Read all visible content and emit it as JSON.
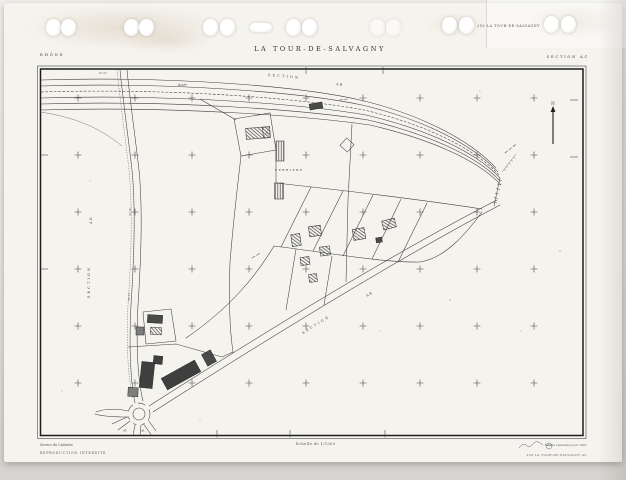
{
  "page": {
    "department": "RHÔNE",
    "title": "LA TOUR-DE-SALVAGNY",
    "section": "SECTION AC",
    "sheet_ref": "250 LA TOUR-DE-SALVAGNY"
  },
  "map": {
    "north": "N",
    "section_labels": {
      "top_word": "SECTION",
      "top_code": "AB",
      "west_word": "SECTION",
      "west_code": "AD",
      "south_word": "SECTION",
      "south_code": "AB"
    },
    "road_label": "Route",
    "lieu_dit": "FERRIERE",
    "adjacent_sheet_left": "AY",
    "adjacent_sheet_right": "AL"
  },
  "footer": {
    "issuer": "Service du Cadastre",
    "notice": "REPRODUCTION INTERDITE",
    "scale": "Echelle de 1/1000",
    "revision_note": "Feuille remaniée pour 1981",
    "sheet_id": "250 LA TOUR-DE-SALVAGNY  AC"
  }
}
